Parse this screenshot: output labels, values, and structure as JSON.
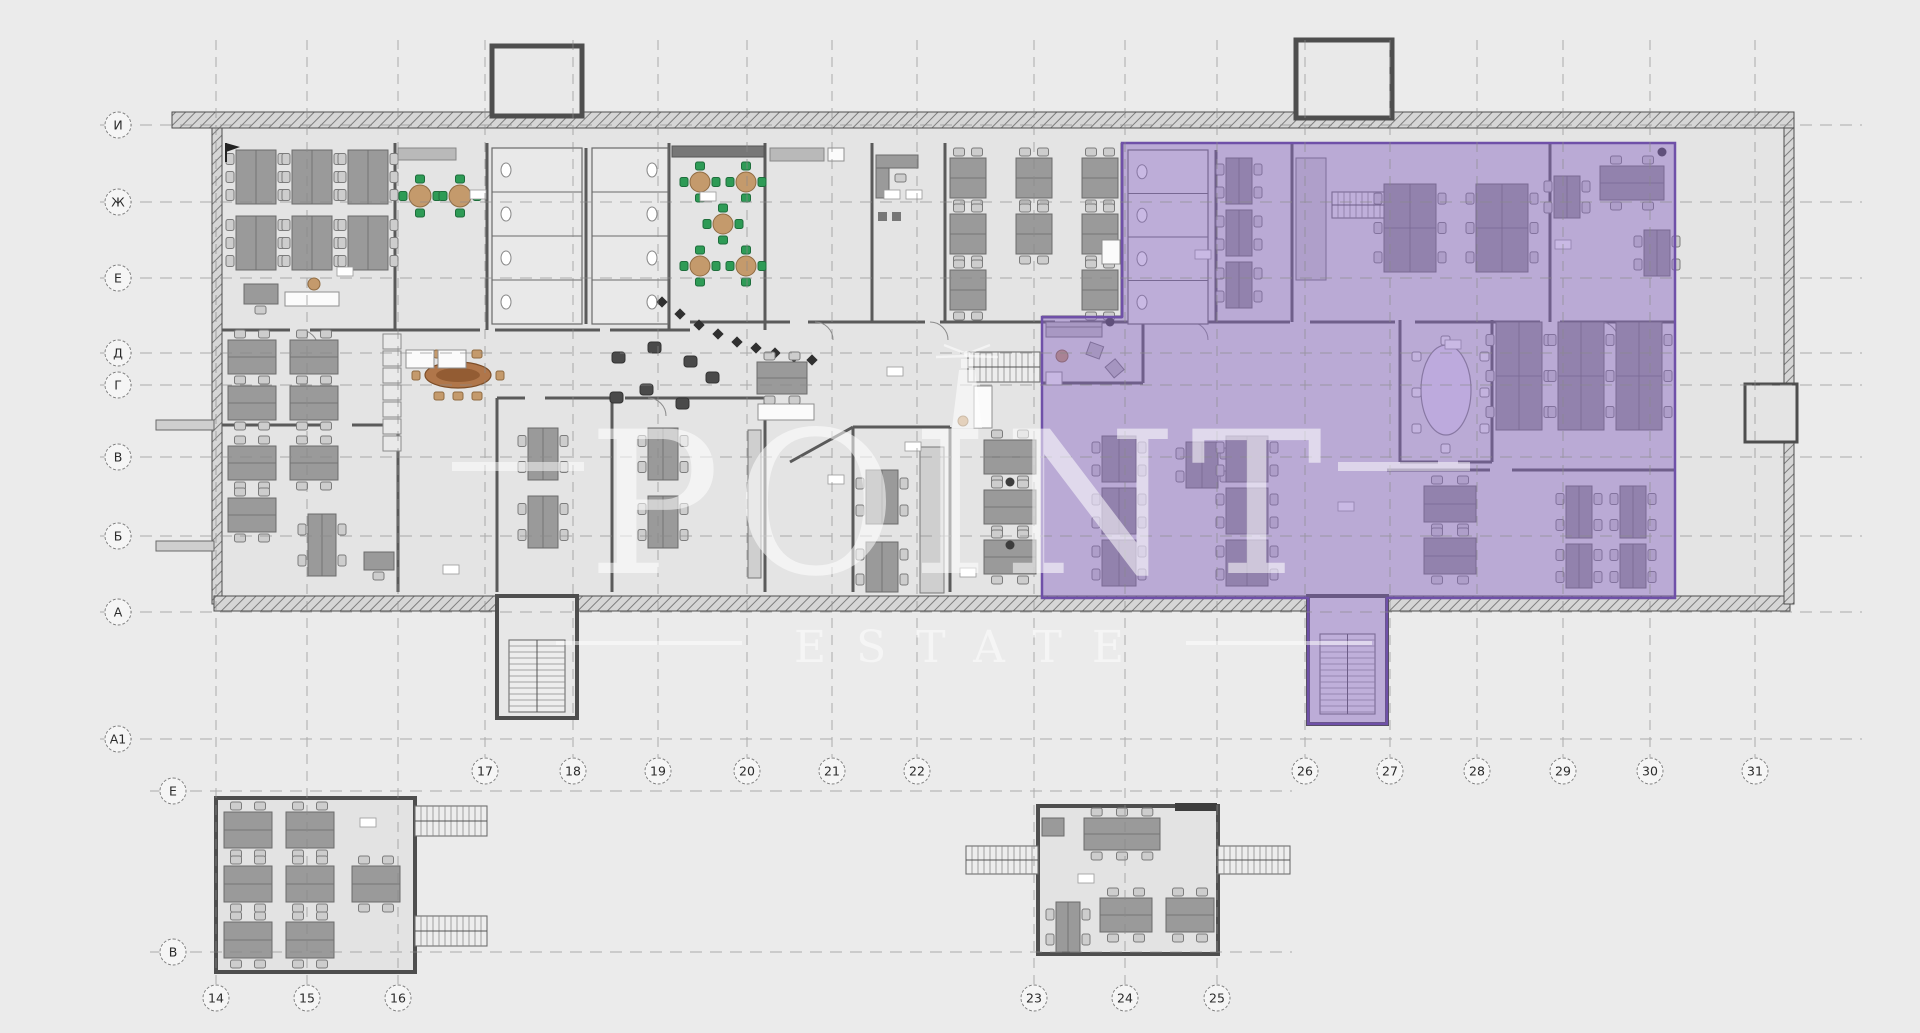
{
  "watermark": {
    "brand": "POINT",
    "brand_sub": "ESTATE"
  },
  "grid": {
    "main_rows": [
      "И",
      "Ж",
      "Е",
      "Д",
      "Г",
      "В",
      "Б",
      "А",
      "А1"
    ],
    "main_columns": [
      "17",
      "18",
      "19",
      "20",
      "21",
      "22",
      "26",
      "27",
      "28",
      "29",
      "30",
      "31"
    ],
    "lower_rows": [
      "Е",
      "В"
    ],
    "lower_left_columns": [
      "14",
      "15",
      "16"
    ],
    "lower_middle_columns": [
      "23",
      "24",
      "25"
    ]
  },
  "colors": {
    "highlight_fill": "#8a67c4",
    "highlight_stroke": "#6f50a8",
    "watermark_text": "#ffffff",
    "plan_walls": "#4e4e4e",
    "desk_fill": "#9a9a9a",
    "accent_green": "#2e9b56",
    "accent_wood": "#b0764a"
  }
}
